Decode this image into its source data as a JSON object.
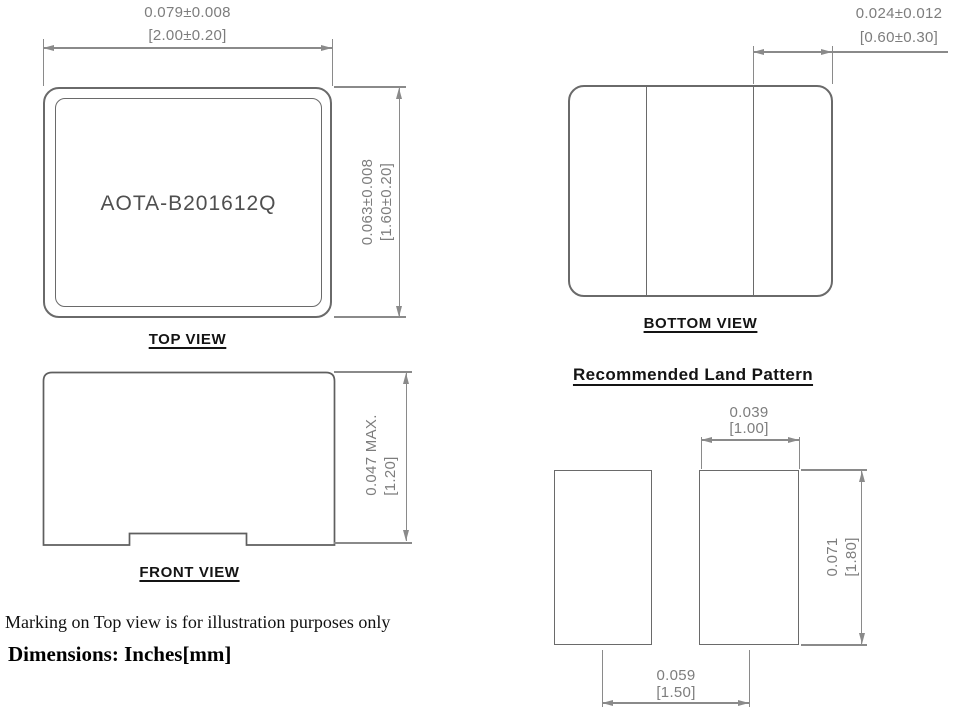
{
  "top_view": {
    "label": "TOP VIEW",
    "part_marking": "AOTA-B201612Q",
    "width_dim": {
      "inches": "0.079±0.008",
      "mm": "[2.00±0.20]"
    },
    "height_dim": {
      "inches": "0.063±0.008",
      "mm": "[1.60±0.20]"
    }
  },
  "front_view": {
    "label": "FRONT VIEW",
    "height_dim": {
      "inches": "0.047 MAX.",
      "mm": "[1.20]"
    }
  },
  "bottom_view": {
    "label": "BOTTOM VIEW",
    "terminal_dim": {
      "inches": "0.024±0.012",
      "mm": "[0.60±0.30]"
    }
  },
  "land_pattern": {
    "title": "Recommended Land Pattern",
    "pad_width_dim": {
      "inches": "0.039",
      "mm": "[1.00]"
    },
    "pad_height_dim": {
      "inches": "0.071",
      "mm": "[1.80]"
    },
    "pad_spacing_dim": {
      "inches": "0.059",
      "mm": "[1.50]"
    }
  },
  "notes": {
    "marking_note": "Marking on Top view is for illustration purposes only",
    "dimensions_note": "Dimensions: Inches[mm]"
  },
  "colors": {
    "outline": "#6a6a6a",
    "dimension": "#8a8a8a",
    "dimension_text": "#7d7d7d",
    "label_text": "#141414"
  }
}
